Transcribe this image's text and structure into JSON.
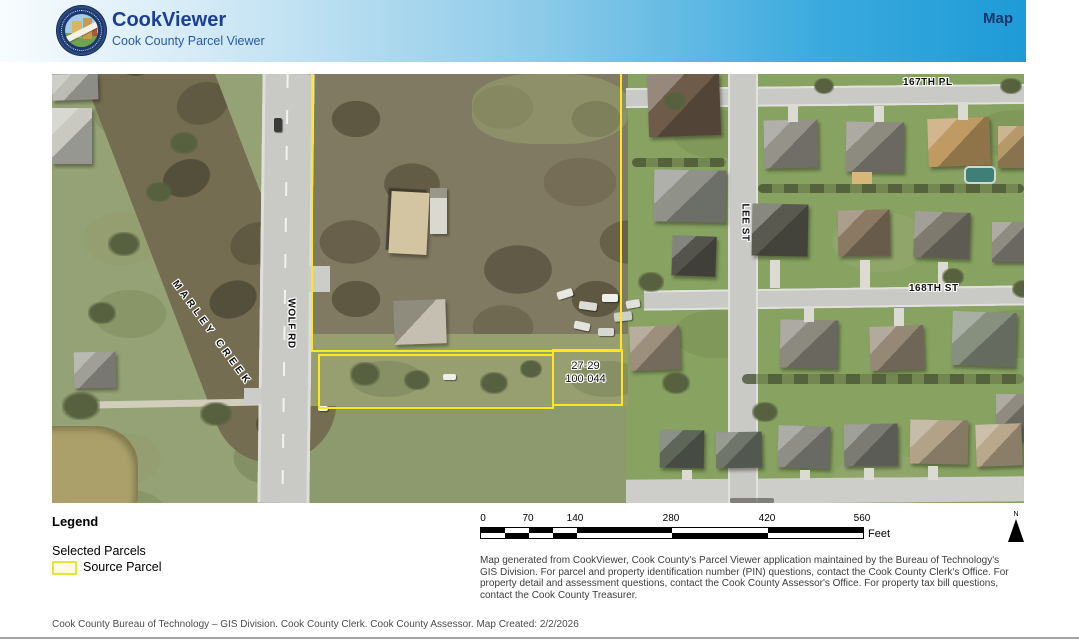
{
  "header": {
    "title": "CookViewer",
    "subtitle": "Cook County Parcel Viewer",
    "nav_map_label": "Map",
    "accent_color": "#1E9BD7",
    "title_color": "#1C3F94",
    "logo": "cook-county-seal"
  },
  "map": {
    "street_labels": {
      "pl167": "167TH PL",
      "st168": "168TH ST",
      "lee": "LEE ST",
      "wolf": "WOLF RD",
      "marley": "MARLEY CREEK"
    },
    "selected_parcel": {
      "pin_line1": "27-29",
      "pin_line2": "100-044"
    },
    "parcel_outline_color": "#FFE71E"
  },
  "legend": {
    "title": "Legend",
    "group_label": "Selected Parcels",
    "item": {
      "label": "Source Parcel",
      "swatch_fill": "#FDFADF",
      "swatch_border": "#E7E33B"
    }
  },
  "scale_bar": {
    "ticks": [
      "0",
      "70",
      "140",
      "280",
      "420",
      "560"
    ],
    "unit": "Feet"
  },
  "north_arrow": {
    "label": "N"
  },
  "notes": {
    "disclaimer": "Map generated from CookViewer, Cook County's Parcel Viewer application maintained by the Bureau of Technology's GIS Division. For parcel and property identification number (PIN) questions, contact the Cook County Clerk's Office. For property detail and assessment questions, contact the Cook County Assessor's Office. For property tax bill questions, contact the Cook County Treasurer.",
    "footer": "Cook County Bureau of Technology – GIS Division. Cook County Clerk. Cook County Assessor. Map Created: 2/2/2026"
  }
}
